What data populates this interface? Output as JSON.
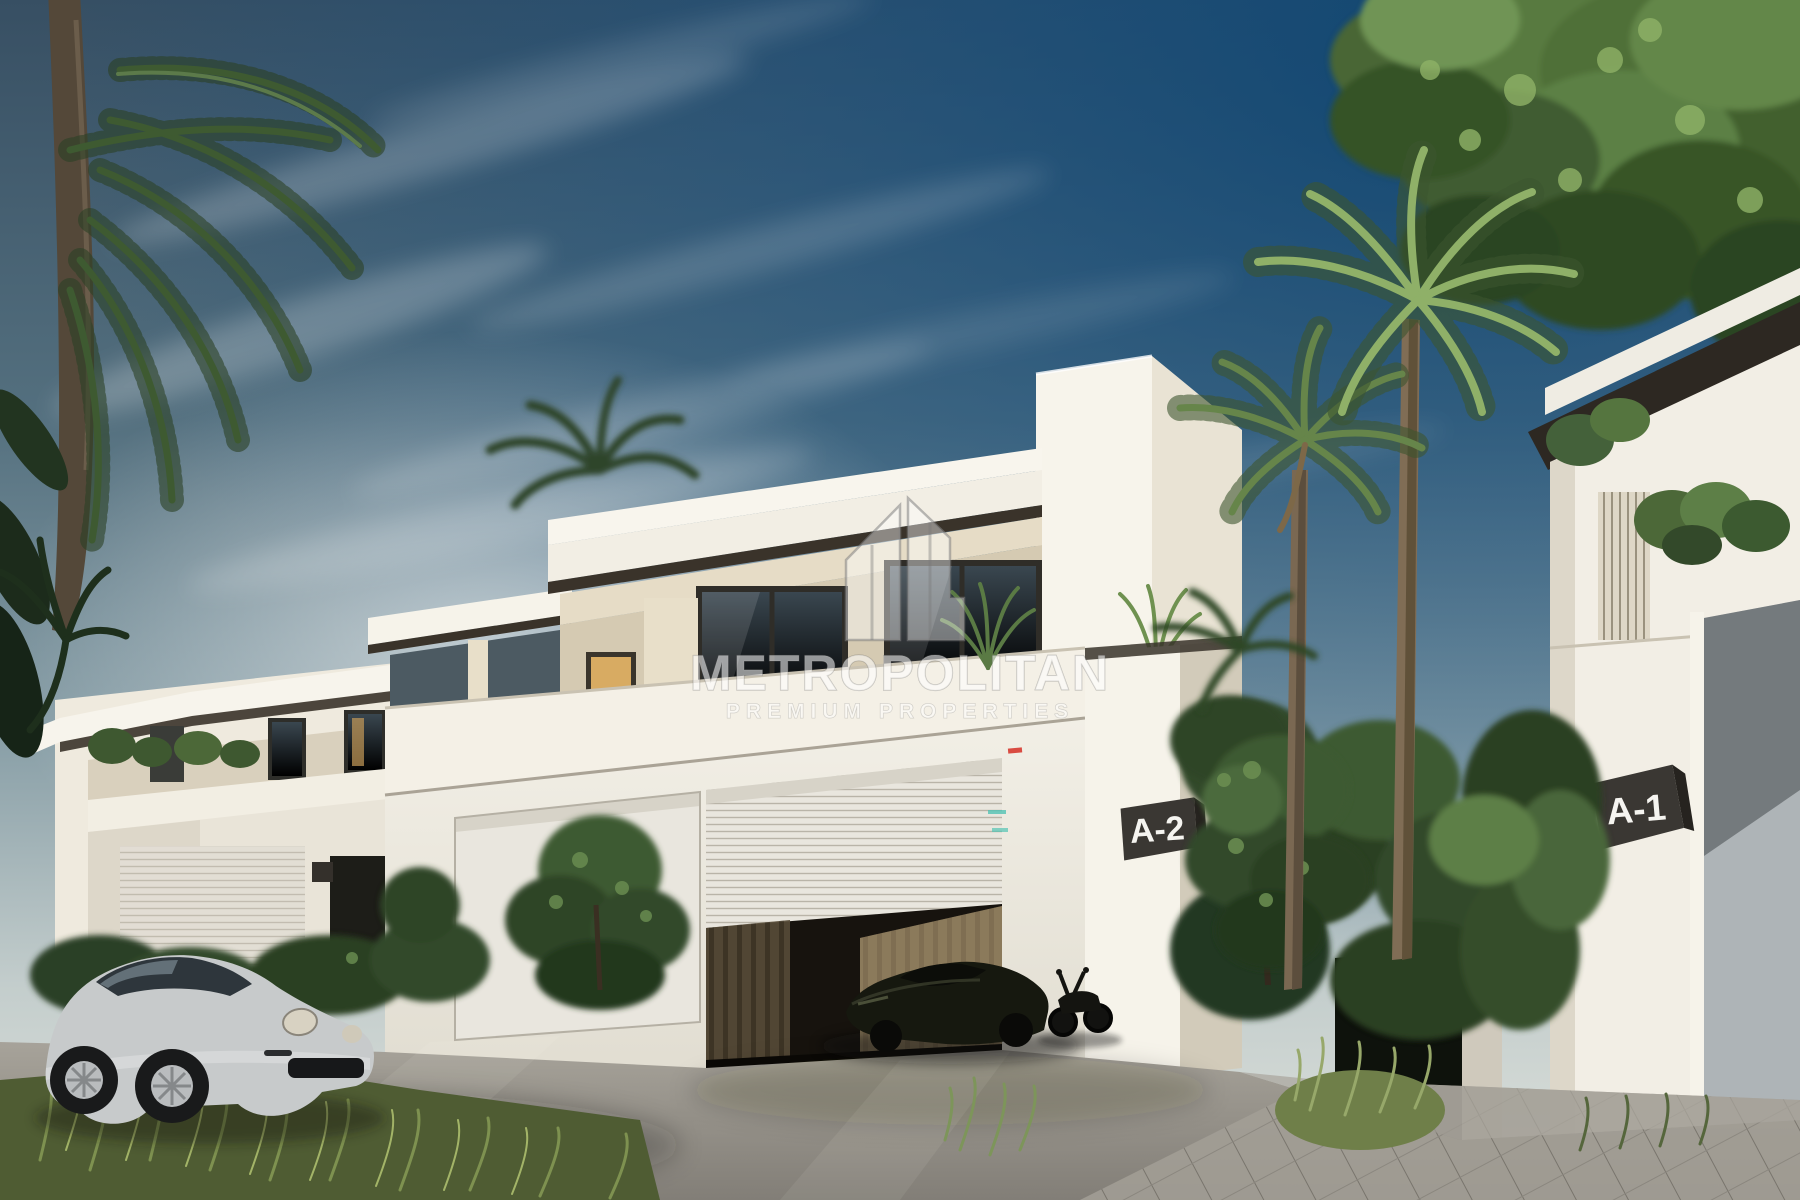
{
  "scene": {
    "alt": "Architectural render of modern white two-storey villas with palm trees, a silver sports car on the street and a dark supercar with a motorcycle in the open garage",
    "plaques": {
      "left_unit": "A-2",
      "right_unit": "A-1"
    }
  },
  "watermark": {
    "brand": "METROPOLITAN",
    "tagline": "PREMIUM PROPERTIES",
    "logo": "metropolitan-buildings-icon"
  },
  "palette": {
    "sky_slate": "#374f63",
    "sky_deep": "#0f4672",
    "sky_pale": "#dfe2dc",
    "wall_white": "#f4f0e7",
    "wall_cream": "#e6dcc6",
    "trim_dark": "#38322a",
    "plaque_dark": "#3a3733",
    "plaque_text": "#f5f4f0",
    "glass_dark": "#3a4750",
    "window_warm": "#d8ab62",
    "roller_door": "#e9e6de",
    "shutter_gray": "#aeb4b7",
    "road_gray": "#9a968e",
    "paver_gray": "#a39f96",
    "foliage_dark": "#2b3f24",
    "foliage_mid": "#4c6838",
    "foliage_light": "#7fa055",
    "palm_trunk": "#544839",
    "car_silver": "#c7cacb",
    "car_dark": "#16180f",
    "watermark_white": "rgba(255,255,255,0.55)"
  }
}
